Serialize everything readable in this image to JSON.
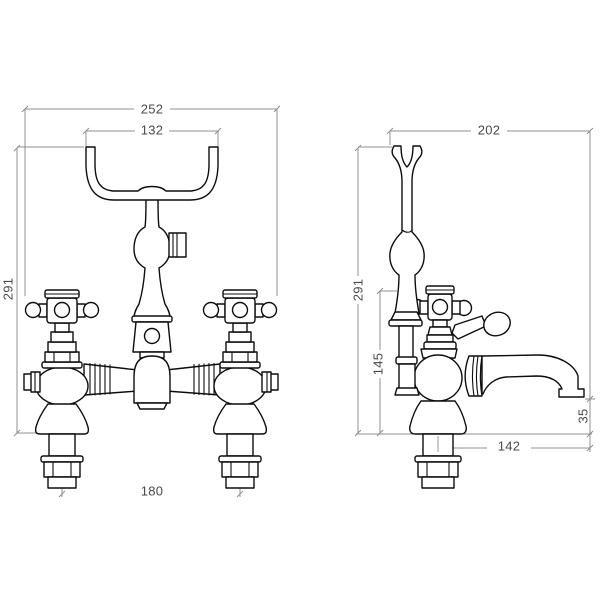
{
  "drawing": {
    "background_color": "#ffffff",
    "line_color": "#0d0d0d",
    "dimension_line_color": "#909090",
    "dimension_text_color": "#4a4a4a"
  },
  "front_view": {
    "overall_width": "252",
    "cradle_width": "132",
    "overall_height": "291",
    "tail_centres": "180"
  },
  "side_view": {
    "overall_depth": "202",
    "overall_height": "291",
    "deck_to_bracket": "145",
    "spout_reach": "142",
    "spout_drop": "35"
  }
}
